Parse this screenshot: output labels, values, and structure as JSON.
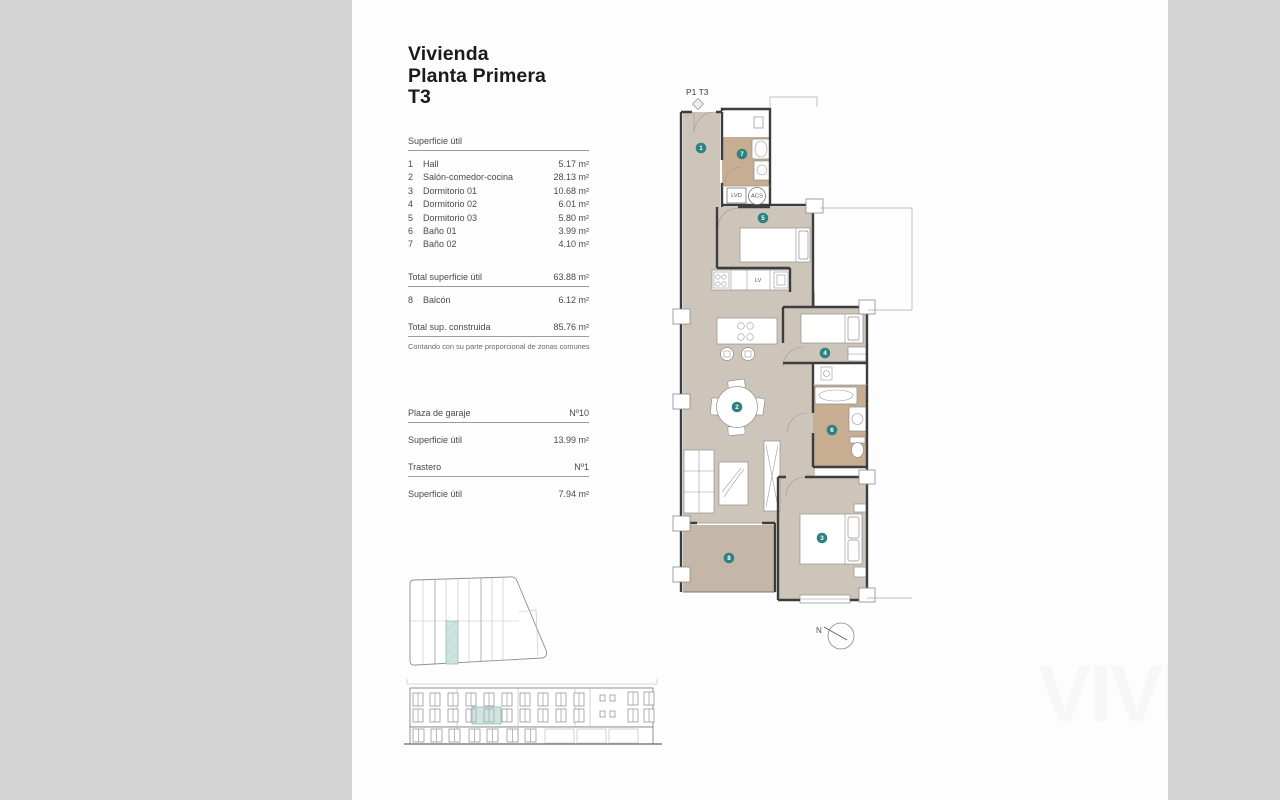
{
  "page": {
    "title_lines": [
      "Vivienda",
      "Planta Primera",
      "T3"
    ],
    "watermark": "VIVE"
  },
  "surface_table": {
    "header": "Superficie útil",
    "rows": [
      {
        "num": "1",
        "label": "Hall",
        "value": "5.17 m²"
      },
      {
        "num": "2",
        "label": "Salón-comedor-cocina",
        "value": "28.13 m²"
      },
      {
        "num": "3",
        "label": "Dormitorio 01",
        "value": "10.68 m²"
      },
      {
        "num": "4",
        "label": "Dormitorio 02",
        "value": "6.01 m²"
      },
      {
        "num": "5",
        "label": "Dormitorio 03",
        "value": "5.80 m²"
      },
      {
        "num": "6",
        "label": "Baño 01",
        "value": "3.99 m²"
      },
      {
        "num": "7",
        "label": "Baño 02",
        "value": "4.10 m²"
      }
    ],
    "total_util": {
      "label": "Total superficie útil",
      "value": "63.88 m²"
    },
    "balcony_row": {
      "num": "8",
      "label": "Balcón",
      "value": "6.12 m²"
    },
    "total_built": {
      "label": "Total sup. construida",
      "value": "85.76 m²"
    },
    "note": "Contando con su parte proporcional de zonas comunes"
  },
  "garage": {
    "garage_label": "Plaza de garaje",
    "garage_value": "Nº10",
    "garage_area_label": "Superficie útil",
    "garage_area_value": "13.99 m²",
    "storage_label": "Trastero",
    "storage_value": "Nº1",
    "storage_area_label": "Superficie útil",
    "storage_area_value": "7.94 m²"
  },
  "plan": {
    "label": "P1 T3",
    "badges": [
      "1",
      "2",
      "3",
      "4",
      "5",
      "6",
      "7",
      "8"
    ],
    "fixtures": {
      "lvd": "LVD",
      "acs": "ACS",
      "lv": "LV"
    },
    "north_label": "N",
    "colors": {
      "floor": "#cec5ba",
      "bath": "#c7ad92",
      "balcony": "#c4b7a8",
      "badge": "#2e8180",
      "highlight": "#cde3df"
    }
  }
}
